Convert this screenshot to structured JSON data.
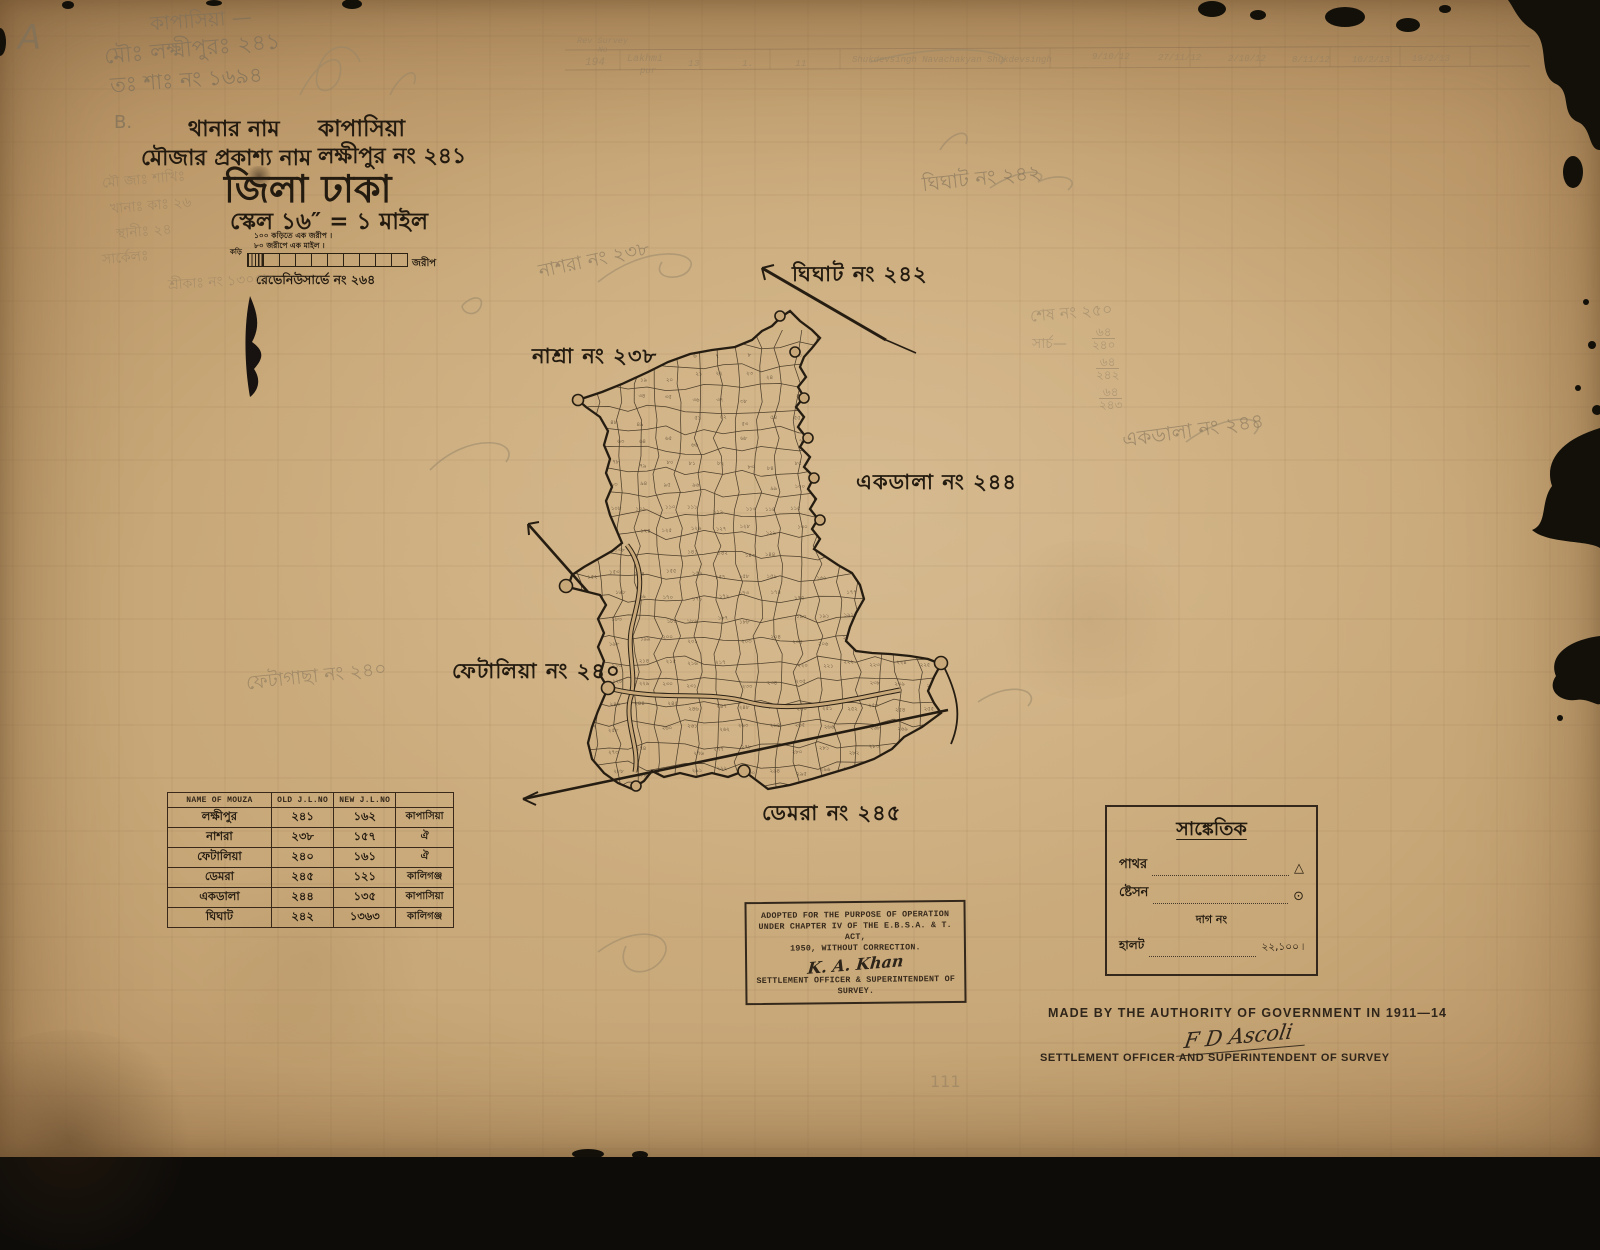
{
  "header": {
    "thana_label": "থানার নাম",
    "thana_value": "কাপাসিয়া",
    "mouza_label": "মৌজার প্রকাশ্য নাম",
    "mouza_value": "লক্ষীপুর নং ২৪১",
    "district": "জিলা ঢাকা",
    "scale_line": "স্কেল ১৬″ = ১ মাইল"
  },
  "scale": {
    "note1": "১০০ কড়িতে এক জরীপ ।",
    "note2": "৮০ জরীপে এক মাইল ।",
    "left_label": "কড়ি",
    "right_label": "জরীপ",
    "revenue_line": "রেভেনিউসার্ভে নং ২৬৪"
  },
  "map_labels": {
    "nashra": "নাশ্রা নং ২৩৮",
    "ghighat": "ঘিঘাট নং ২৪২",
    "ekdala": "একডালা নং ২৪৪",
    "fetalia": "ফেটালিয়া নং ২৪০",
    "demra": "ডেমরা নং ২৪৫"
  },
  "pencil": {
    "corner_a": "A",
    "corner_b": "B.",
    "kapasia_dash": "কাপাসিয়া —",
    "mou_line": "মৌঃ লক্ষ্মীপুরঃ ২৪১",
    "ta_sha_line": "তঃ শাঃ নং ১৬৯৪",
    "left_col_1": "মৌ জাঃ শাখিঃ",
    "left_col_2": "খানাঃ কাঃ ২৬",
    "left_col_3": "স্থানীঃ ২৪",
    "left_col_4": "সার্কেলঃ",
    "left_col_5": "শ্রীকাঃ নং ১৩০৫৮",
    "nashra_hw": "নাশরা নং ২৩৮",
    "ghighat_hw": "ঘিঘাট নং ২৪২",
    "ekdala_hw": "একডালা নং ২৪৪",
    "fetalia_hw": "ফেটাগাছা নং ২৪০",
    "shesh_no": "শেষ নং ২৫০",
    "sarch": "সার্চ—",
    "frac1_n": "৬৪",
    "frac1_d": "২৪০",
    "frac2_n": "৬৪",
    "frac2_d": "২৪২",
    "frac3_n": "৬৪",
    "frac3_d": "২৪৩",
    "one_one_one": "111"
  },
  "survey_row": {
    "rev_label": "Rev Survey",
    "rev_label2": "No",
    "num": "194",
    "name1": "Lakhmi",
    "name2": "pur",
    "c1": "13",
    "c2": "1.",
    "c3": "11",
    "names": "Shukdevsingh  Navachakyan  Shukdevsingh",
    "d1": "9/10/12",
    "d2": "27/11/12",
    "d3": "2/10/12",
    "d4": "8/11/12",
    "d5": "10/2/13",
    "d6": "19/2/13"
  },
  "table": {
    "headers": [
      "NAME OF MOUZA",
      "OLD J.L.NO",
      "NEW J.L.NO",
      ""
    ],
    "rows": [
      {
        "name": "লক্ষীপুর",
        "old": "২৪১",
        "new": "১৬২",
        "thana": "কাপাসিয়া"
      },
      {
        "name": "নাশরা",
        "old": "২৩৮",
        "new": "১৫৭",
        "thana": "ঐ"
      },
      {
        "name": "ফেটালিয়া",
        "old": "২৪০",
        "new": "১৬১",
        "thana": "ঐ"
      },
      {
        "name": "ডেমরা",
        "old": "২৪৫",
        "new": "১২১",
        "thana": "কালিগঞ্জ"
      },
      {
        "name": "একডালা",
        "old": "২৪৪",
        "new": "১৩৫",
        "thana": "কাপাসিয়া"
      },
      {
        "name": "ঘিঘাট",
        "old": "২৪২",
        "new": "১৩৬৩",
        "thana": "কালিগঞ্জ"
      }
    ]
  },
  "stamp": {
    "line1": "ADOPTED FOR THE PURPOSE OF OPERATION",
    "line2": "UNDER CHAPTER IV OF THE E.B.S.A. & T. ACT,",
    "line3": "1950, WITHOUT CORRECTION.",
    "signature": "K. A. Khan",
    "line4": "SETTLEMENT OFFICER & SUPERINTENDENT OF",
    "line5": "SURVEY."
  },
  "legend": {
    "title": "সাঙ্কেতিক",
    "row1_label": "পাথর",
    "row1_symbol": "△",
    "row2_label": "ষ্টেসন",
    "row2_symbol": "⊙",
    "note": "দাগ নং",
    "row3_label": "হালট",
    "row3_value": "২২,১০০ ৷"
  },
  "imprint": {
    "line1": "MADE BY THE AUTHORITY OF GOVERNMENT IN 1911—14",
    "signature": "F D Ascoli",
    "line2": "SETTLEMENT OFFICER AND SUPERINTENDENT OF SURVEY"
  },
  "colors": {
    "paper": "#c8a878",
    "ink": "#241b10",
    "pencil": "#8d7c61"
  }
}
